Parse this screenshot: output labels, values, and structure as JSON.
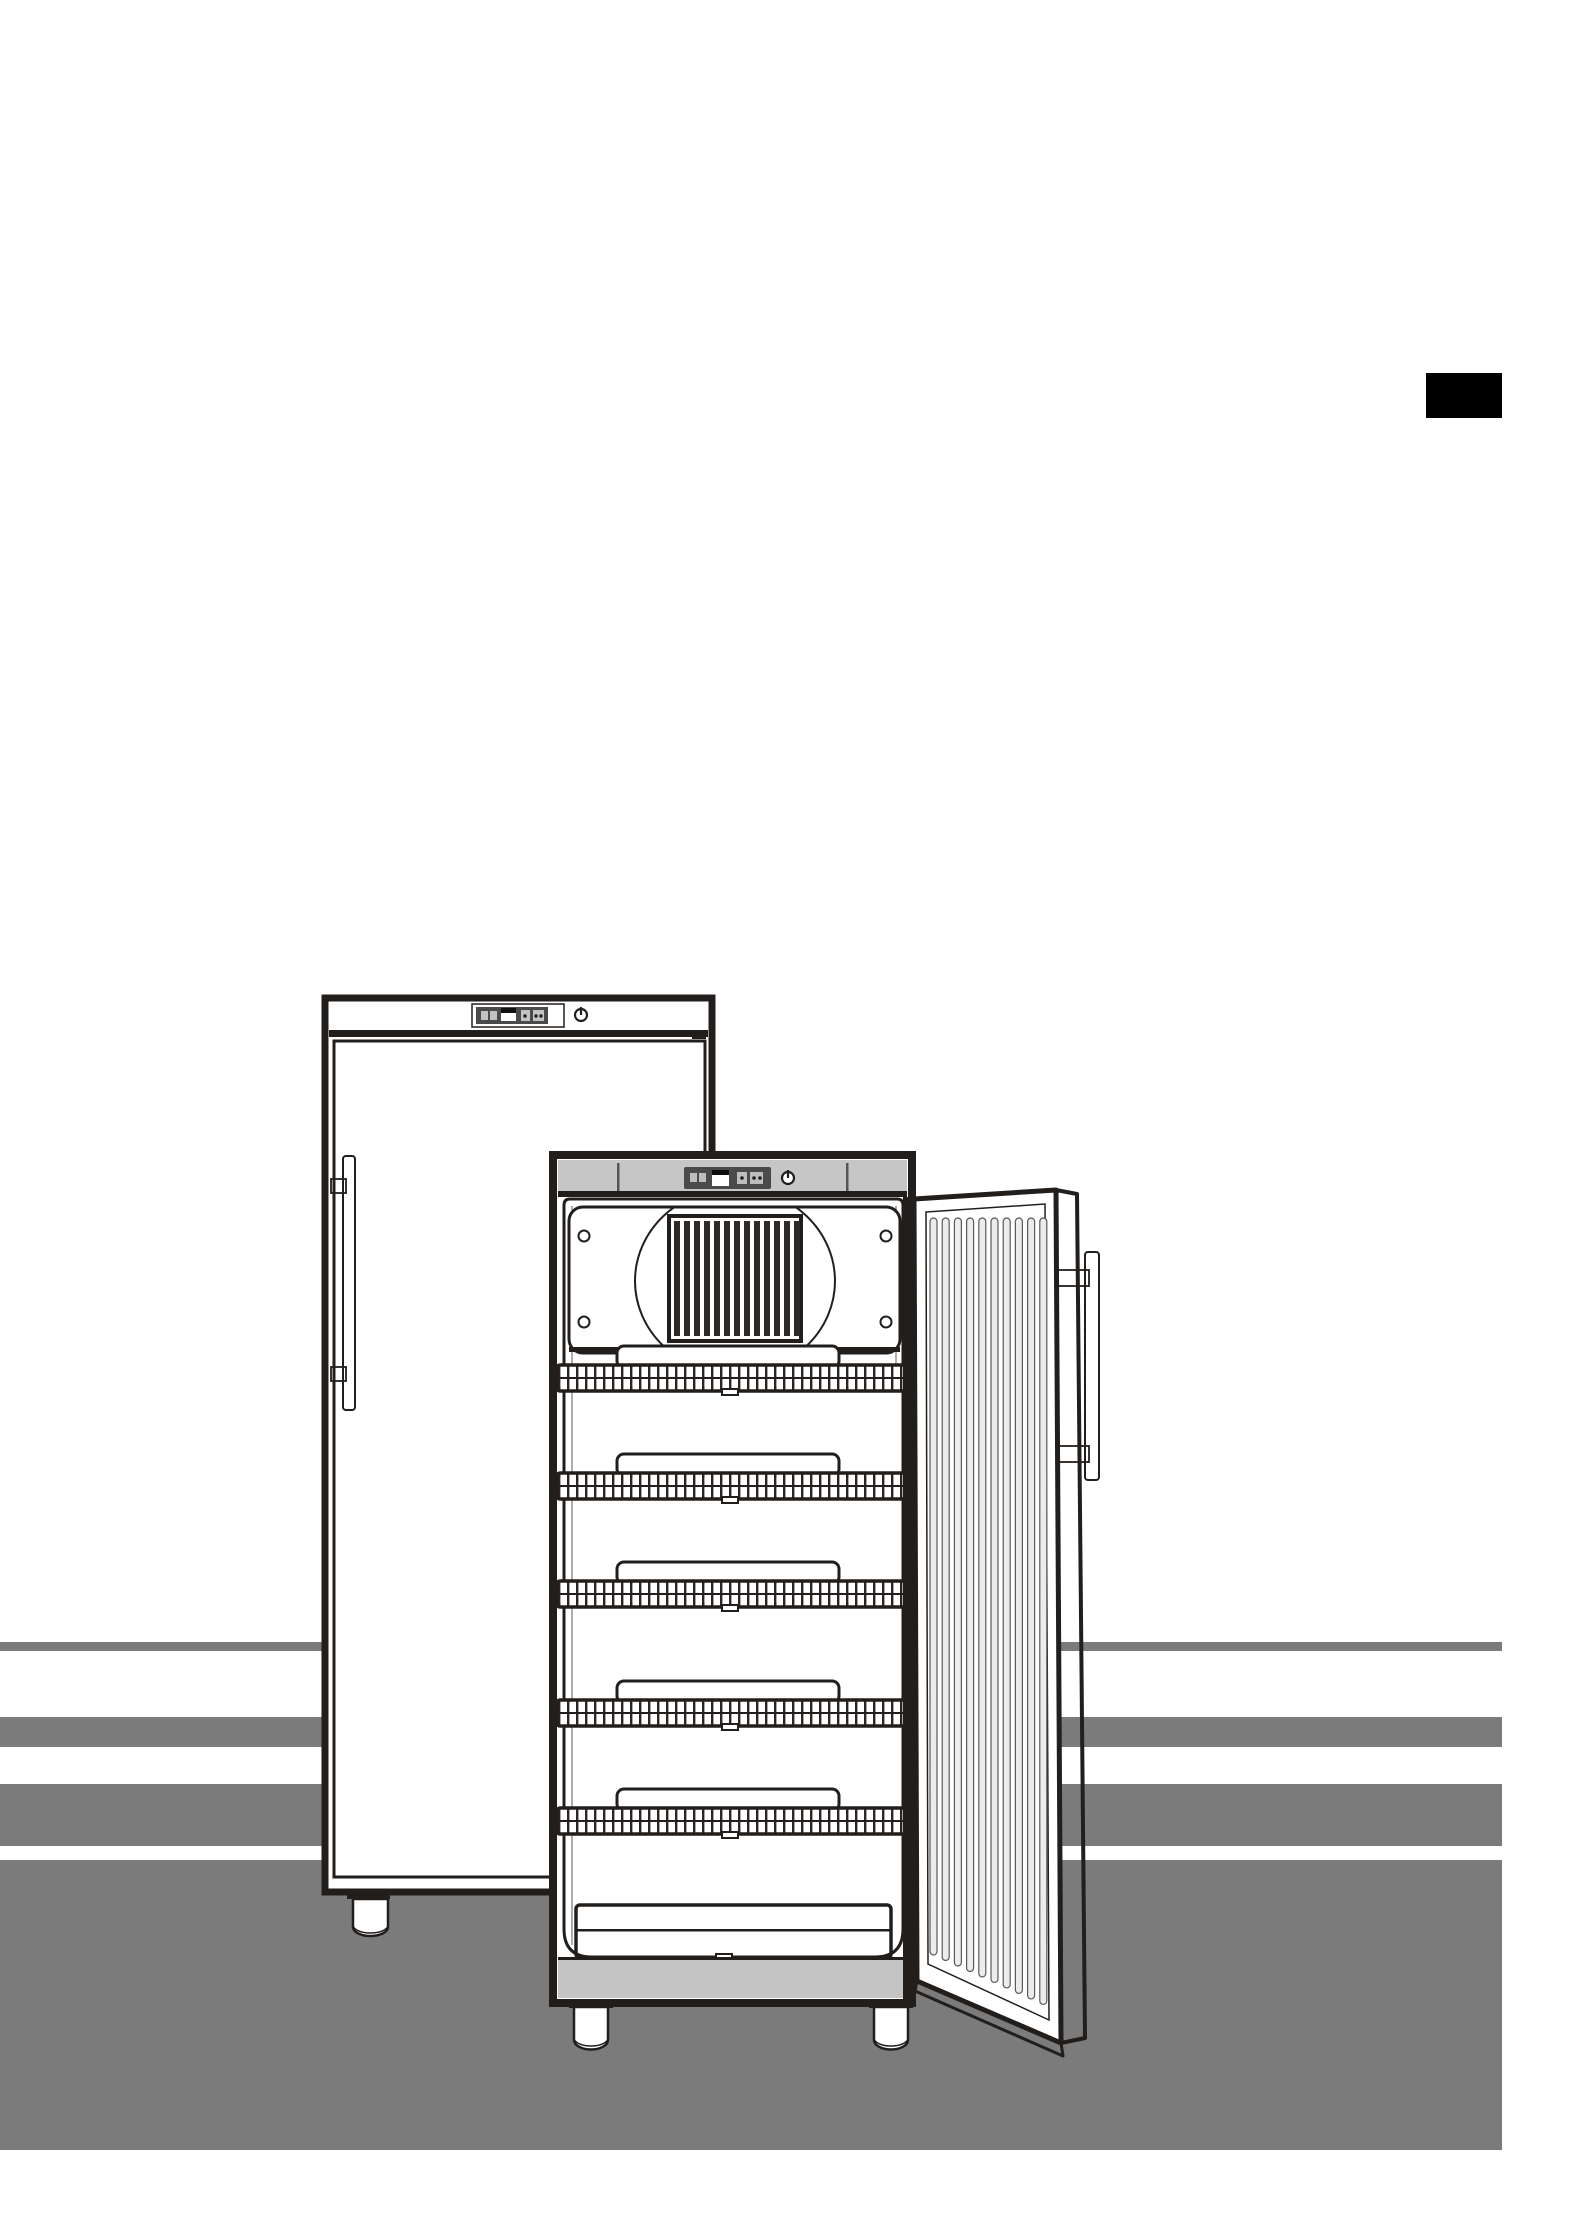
{
  "page": {
    "width": 1576,
    "height": 2230,
    "background": "#ffffff"
  },
  "corner_tab": {
    "x": 1426,
    "y": 373,
    "width": 76,
    "height": 45,
    "color": "#000000"
  },
  "floor_stripes": {
    "color": "#7b7b7b",
    "right_edge": 1502,
    "bands": [
      {
        "top": 1642,
        "height": 9
      },
      {
        "top": 1717,
        "height": 30
      },
      {
        "top": 1784,
        "height": 62
      },
      {
        "top": 1860,
        "height": 290
      }
    ]
  },
  "palette": {
    "ink": "#221e1c",
    "band_gray": "#c6c6c6",
    "panel_dark": "#4a4a4a",
    "metal_gray": "#a9a9a9",
    "edge_gray": "#b9b9b9",
    "button_gray": "#c2c2c2",
    "plinth_gray": "#c4c4c4",
    "rib_fill": "#ececec",
    "slat_dark": "#2e2a28"
  },
  "closed_unit": {
    "handle_side": "left",
    "control_buttons": 4,
    "has_display": true,
    "has_power_icon": true,
    "feet_visible": 1
  },
  "open_unit": {
    "shelf_count": 5,
    "shelf_tops": [
      1365,
      1473,
      1581,
      1700,
      1808
    ],
    "floor_grille": true,
    "vent_slat_count": 13,
    "screw_positions": [
      [
        584,
        1236
      ],
      [
        584,
        1322
      ],
      [
        886,
        1236
      ],
      [
        886,
        1322
      ]
    ],
    "feet_x": [
      569,
      869
    ],
    "door": {
      "rib_count": 10,
      "handle_side": "right"
    }
  }
}
